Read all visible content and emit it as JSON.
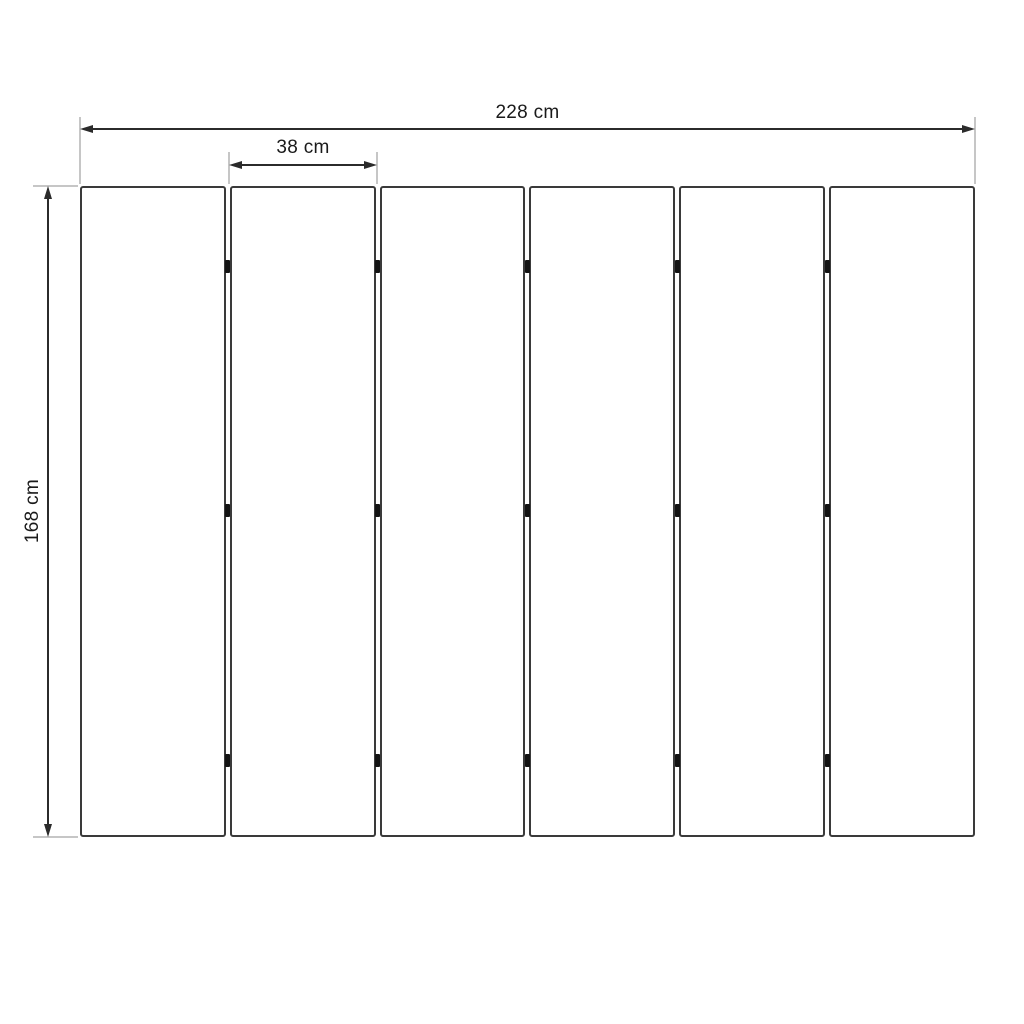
{
  "diagram": {
    "type": "dimension-drawing",
    "dimensions": {
      "total_width": {
        "label": "228 cm",
        "value": 228,
        "unit": "cm"
      },
      "panel_width": {
        "label": "38 cm",
        "value": 38,
        "unit": "cm"
      },
      "height": {
        "label": "168 cm",
        "value": 168,
        "unit": "cm"
      }
    },
    "panels": {
      "count": 6,
      "gaps": 5,
      "hinges_per_gap": 3,
      "hinge_fractions": [
        0.123,
        0.498,
        0.882
      ]
    },
    "colors": {
      "background": "#ffffff",
      "panel_border": "#3a3a3a",
      "panel_fill": "#ffffff",
      "dimension_line": "#2b2b2b",
      "extension_line": "#b3b3b3",
      "hinge": "#141414",
      "text": "#1a1a1a"
    }
  }
}
